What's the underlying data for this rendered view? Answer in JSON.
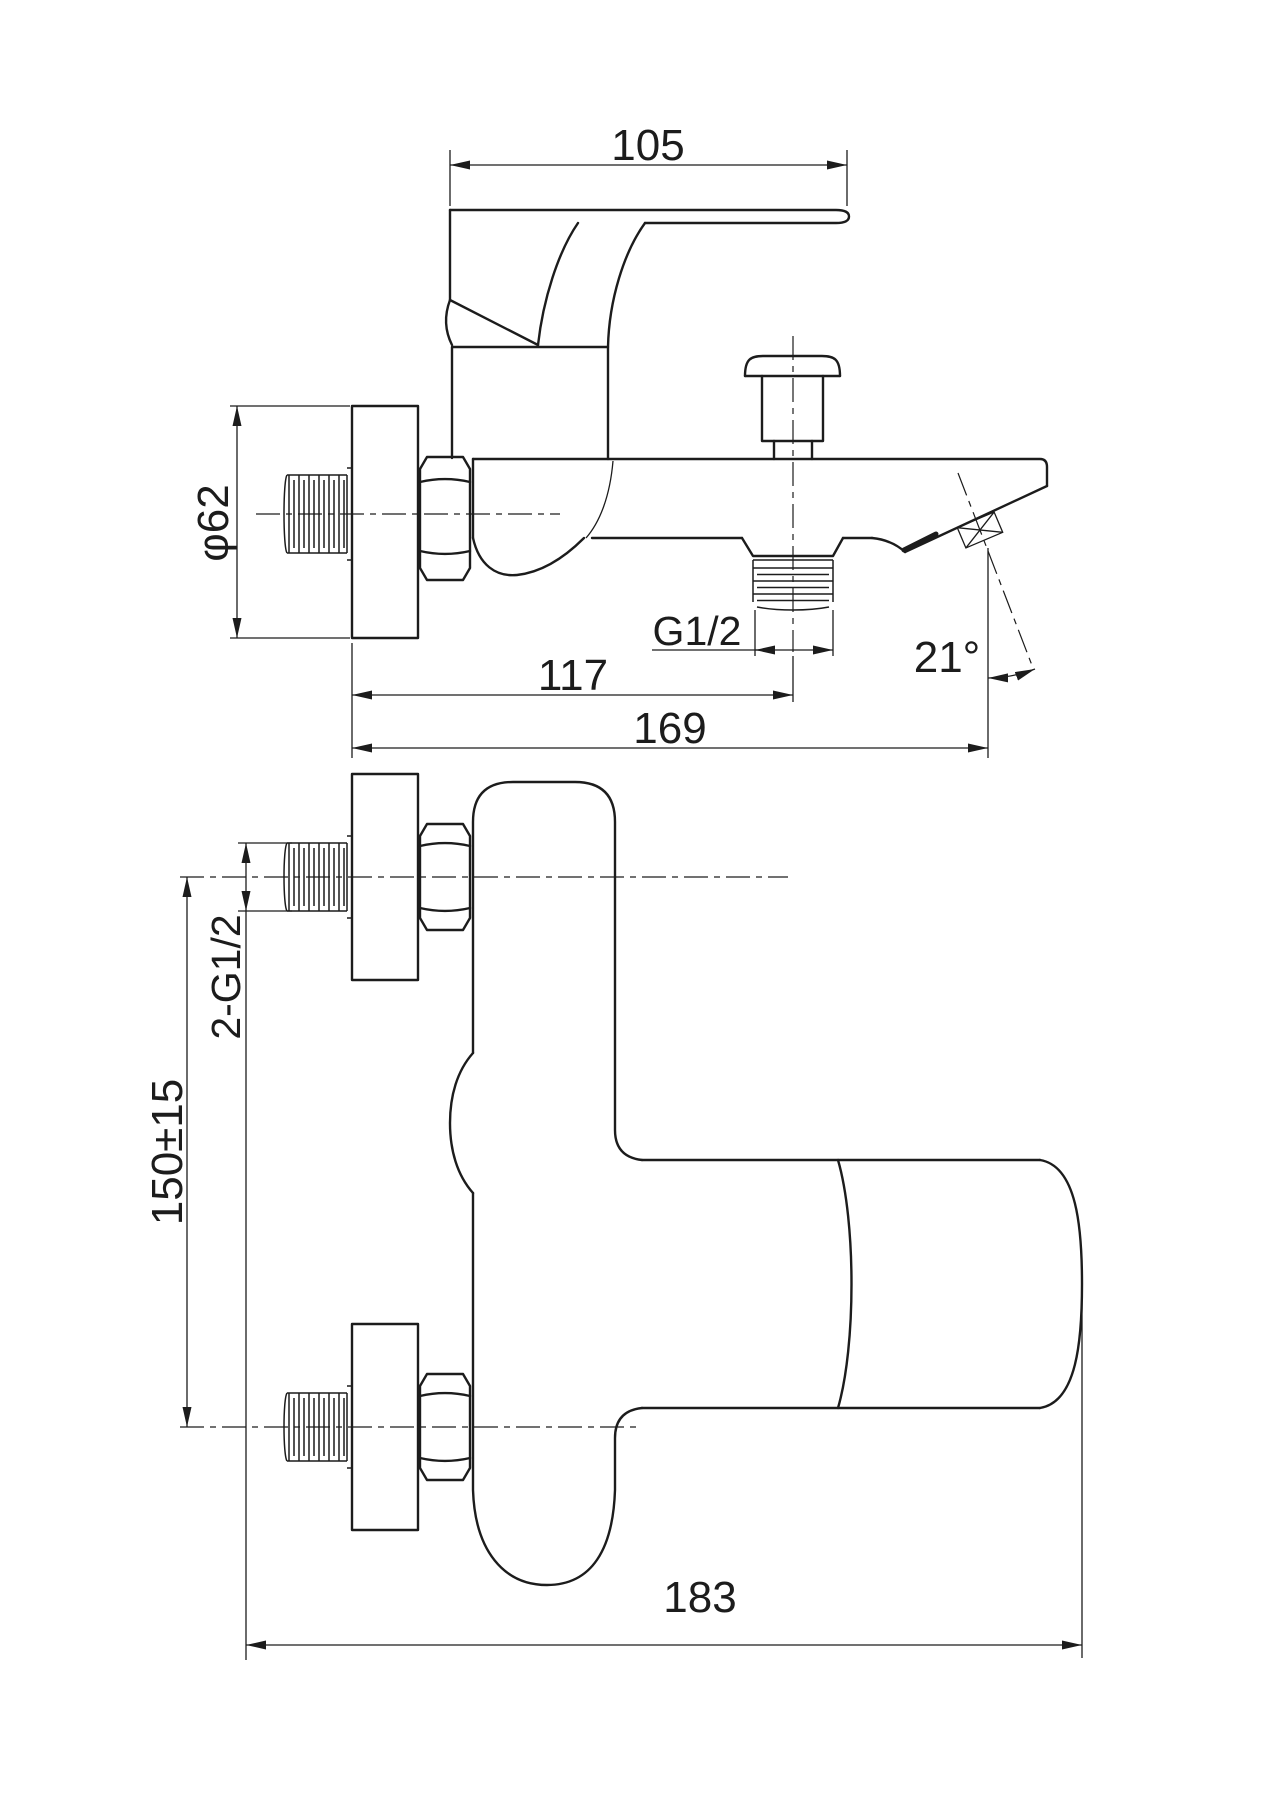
{
  "labels": {
    "handle_length": "105",
    "flange_diameter": "φ62",
    "outlet_thread": "G1/2",
    "outlet_offset": "117",
    "projection": "169",
    "spout_angle": "21°",
    "inlet_thread": "2-G1/2",
    "inlet_spacing": "150±15",
    "body_width": "183"
  },
  "colors": {
    "line": "#1c1c1c",
    "background": "#ffffff"
  }
}
